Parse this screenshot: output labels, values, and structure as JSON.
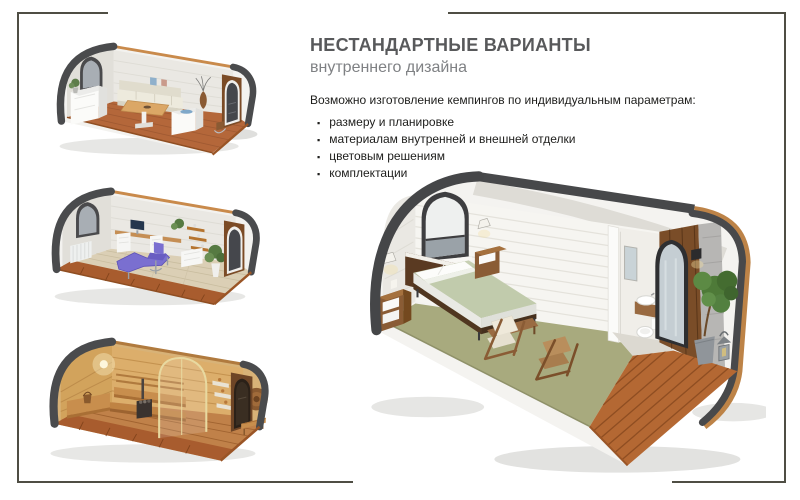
{
  "slide": {
    "title": "НЕСТАНДАРТНЫЕ ВАРИАНТЫ",
    "subtitle": "внутреннего дизайна",
    "intro": "Возможно изготовление кемпингов по индивидуальным параметрам:",
    "bullet_char": "▪",
    "bullets": [
      {
        "label": "размеру и планировке"
      },
      {
        "label": "материалам внутренней и внешней отделки"
      },
      {
        "label": "цветовым решениям"
      },
      {
        "label": "комплектации"
      }
    ],
    "images": [
      {
        "name": "dining-pod-render"
      },
      {
        "name": "office-pod-render"
      },
      {
        "name": "sauna-pod-render"
      },
      {
        "name": "bedroom-pod-render"
      }
    ],
    "colors": {
      "title": "#58595b",
      "subtitle": "#7f8184",
      "body": "#1d1d1b",
      "frame": "#4f4e44"
    }
  }
}
